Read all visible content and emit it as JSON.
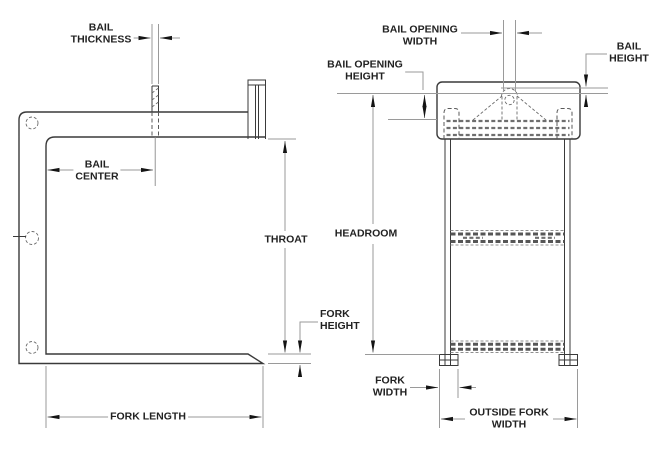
{
  "drawing": {
    "description": "Two-view dimensional line drawing of a lifting fork / bail attachment",
    "views": {
      "left": "side profile view",
      "right": "front view"
    }
  },
  "labels": {
    "bail_thickness": "BAIL\nTHICKNESS",
    "bail_center": "BAIL\nCENTER",
    "throat": "THROAT",
    "fork_height": "FORK\nHEIGHT",
    "fork_length": "FORK LENGTH",
    "bail_opening_width": "BAIL OPENING\nWIDTH",
    "bail_opening_height": "BAIL OPENING\nHEIGHT",
    "bail_height": "BAIL\nHEIGHT",
    "headroom": "HEADROOM",
    "fork_width": "FORK\nWIDTH",
    "outside_fork_width": "OUTSIDE FORK\nWIDTH"
  },
  "colors": {
    "background": "#ffffff",
    "object_line": "#3a3a3a",
    "hidden_line": "#5a5a5a",
    "dimension_line": "#9a9a9a",
    "arrowhead": "#141414",
    "label_text": "#222222"
  }
}
